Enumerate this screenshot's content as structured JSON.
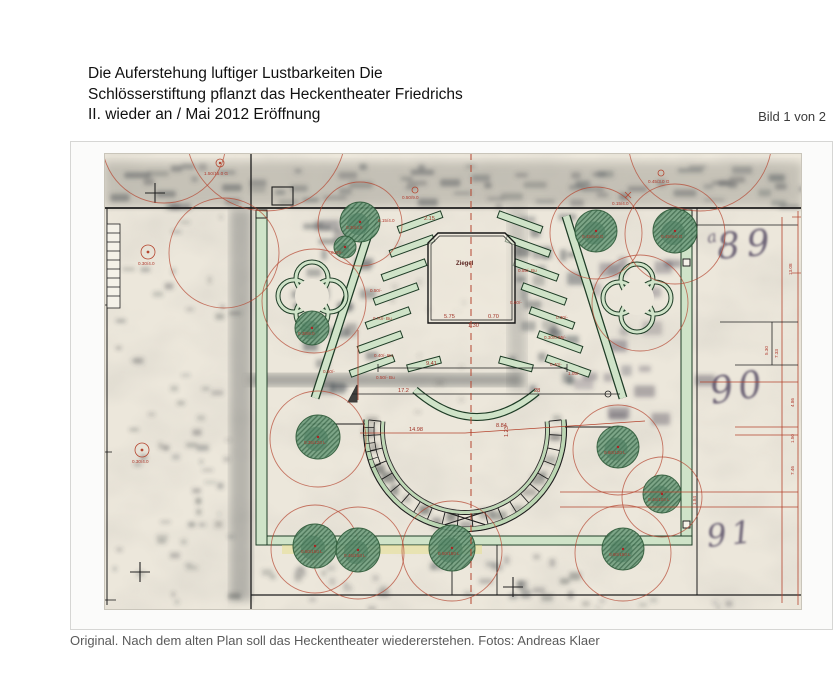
{
  "page": {
    "title": "Die Auferstehung luftiger Lustbarkeiten Die\nSchlösserstiftung pflanzt das Heckentheater Friedrichs\nII. wieder an / Mai 2012 Eröffnung",
    "image_counter": "Bild 1 von 2",
    "caption": "Original. Nach dem alten Plan soll das Heckentheater wiedererstehen. Fotos: Andreas Klaer"
  },
  "plan": {
    "stage_label": "Ziegel",
    "dims": {
      "d941": "9.41",
      "d1498": "14.98",
      "d884": "8.84",
      "d123": "1.23",
      "d172": "17.2",
      "d28": "28",
      "d575": "5.75",
      "d070": "0.70",
      "d130": "1.30",
      "d215": "2.15"
    },
    "right_dims": [
      "13.08",
      "5.30",
      "7.33",
      "4.86",
      "1.50",
      "7.46",
      "1.84"
    ],
    "markers": [
      "1.50/15.0 G",
      "0.45/3.0 G",
      "0.15/4.0",
      "0.50/9.0",
      "0.30/4.0",
      "0.30/4.0"
    ],
    "hedge_labels": [
      "0.15/4.0",
      "0.50/-",
      "0.70/- Bu",
      "0.40/- Bu",
      "0.50/- Bu",
      "0.50/-",
      "0.55/- Bu",
      "0.60/-",
      "0.30/-",
      "0.30/0.95/-",
      "0.40/-",
      "1.05/-"
    ],
    "tree_labels": [
      "0.30/4.5",
      "0.45/8.0 G",
      "0.45/9.0 G",
      "0.20/-",
      "0.30/6.0",
      "0.35/120 L",
      "0.50/150 L",
      "0.45/150 L",
      "0.50/150 L",
      "0.60/120 L",
      "0.45/100 L",
      "0.60/150 L"
    ],
    "handwriting": {
      "prefix": "a",
      "p89": "89",
      "p90": "90",
      "p91": "91"
    },
    "colors": {
      "annotation_red": "#b5452f",
      "hedge_green": "#cfe3c8",
      "tree_green": "#73a081",
      "paper": "#ece7db"
    }
  }
}
